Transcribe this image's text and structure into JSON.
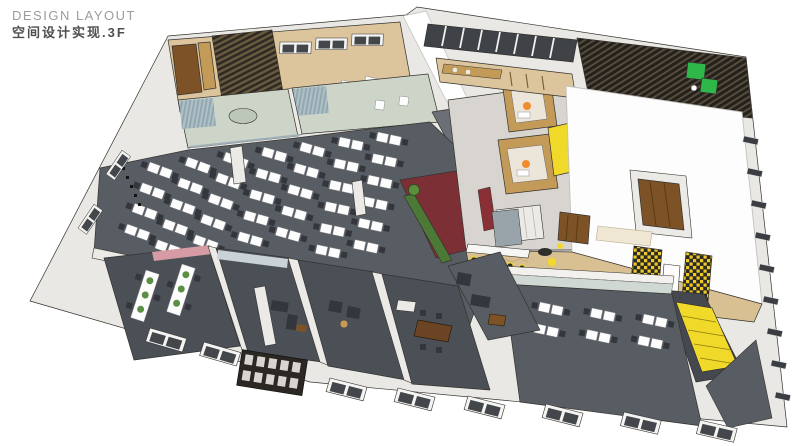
{
  "header": {
    "title": "DESIGN LAYOUT",
    "subtitle": "空间设计实现.3F"
  },
  "palette": {
    "wall_light": "#e9e8e5",
    "wall_shadow": "#6b7076",
    "carpet_dark": "#585d64",
    "carpet_darker": "#4b5057",
    "meeting_green": "#ccd5c8",
    "curtain_teal": "#a3bcc3",
    "wood_light": "#dcc49c",
    "wood_mid": "#c49a58",
    "wood_dark": "#7c5226",
    "herringbone": "#d9c093",
    "maroon": "#7c3036",
    "hedge_green": "#4c7a36",
    "accent_yellow": "#f0d928",
    "sofa_green": "#2eb84a",
    "accent_orange": "#f08c2e",
    "glass_dark": "#3f4347",
    "glass_front": "#cfd8d2",
    "pink_band": "#d69ba4",
    "white_slab": "#fdfdfd",
    "core_gray": "#d8d5d1",
    "stair_dark": "#45494f",
    "cream": "#efe7d4",
    "title_gray": "#9c9c9a",
    "subtitle_gray": "#4f4f4d"
  }
}
